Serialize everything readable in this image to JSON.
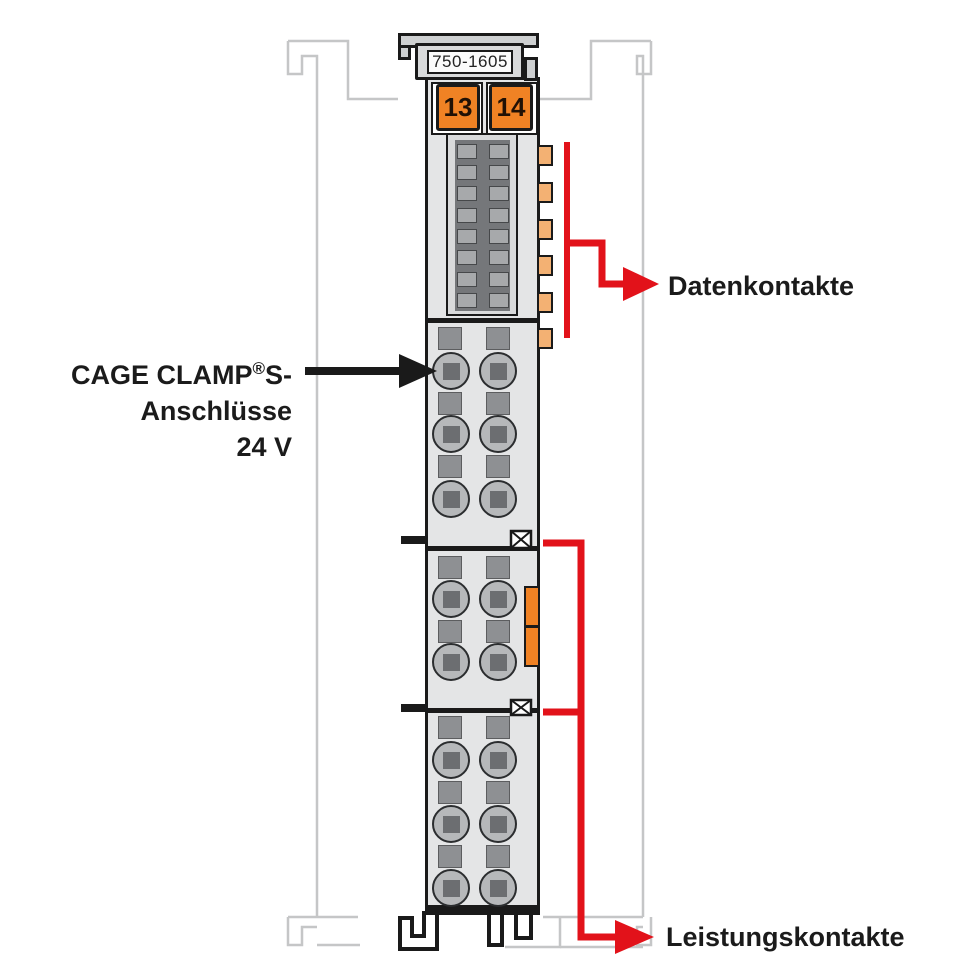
{
  "module": {
    "product_code": "750-1605",
    "coding_buttons": [
      "13",
      "14"
    ]
  },
  "labels": {
    "data_contacts": "Datenkontakte",
    "power_contacts": "Leistungskontakte",
    "cage_clamp": {
      "line1_pre": "CAGE CLAMP",
      "reg": "®",
      "line1_post": "S-",
      "line2": "Anschlüsse",
      "line3": "24 V"
    }
  },
  "colors": {
    "accent_red": "#e2121a",
    "button_orange": "#f08224",
    "contact_tan": "#f3b173",
    "housing_gray": "#e4e5e6",
    "panel_dark_gray": "#75777a",
    "rail_outline_gray": "#c5c6c7",
    "outline_black": "#1a1a1a"
  }
}
